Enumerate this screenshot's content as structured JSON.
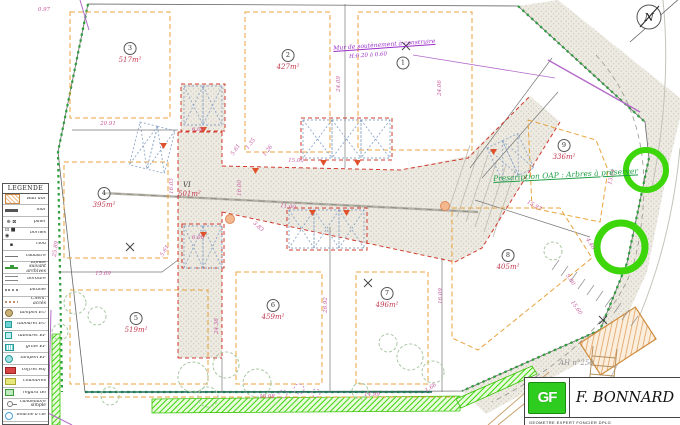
{
  "plan": {
    "north_label": "N",
    "road_label": {
      "name": "VI",
      "area": "501m²"
    },
    "lots": [
      {
        "num": "1",
        "area": "",
        "x": 403,
        "y": 63
      },
      {
        "num": "2",
        "area": "427m²",
        "x": 288,
        "y": 60
      },
      {
        "num": "3",
        "area": "517m²",
        "x": 130,
        "y": 53
      },
      {
        "num": "4",
        "area": "395m²",
        "x": 104,
        "y": 198
      },
      {
        "num": "5",
        "area": "519m²",
        "x": 136,
        "y": 323
      },
      {
        "num": "6",
        "area": "459m²",
        "x": 273,
        "y": 310
      },
      {
        "num": "7",
        "area": "496m²",
        "x": 387,
        "y": 298
      },
      {
        "num": "8",
        "area": "405m²",
        "x": 508,
        "y": 260
      },
      {
        "num": "9",
        "area": "336m²",
        "x": 564,
        "y": 150
      }
    ],
    "dimensions": [
      {
        "t": "0.97",
        "x": 44,
        "y": 10,
        "r": 0
      },
      {
        "t": "20.91",
        "x": 108,
        "y": 124,
        "r": 0
      },
      {
        "t": "24.09",
        "x": 339,
        "y": 84,
        "r": -90
      },
      {
        "t": "24.06",
        "x": 440,
        "y": 88,
        "r": -90
      },
      {
        "t": "1.35",
        "x": 251,
        "y": 144,
        "r": -52
      },
      {
        "t": "1.26",
        "x": 268,
        "y": 151,
        "r": -52
      },
      {
        "t": "15.00",
        "x": 296,
        "y": 161,
        "r": 2
      },
      {
        "t": "11.00",
        "x": 288,
        "y": 207,
        "r": 6
      },
      {
        "t": "6.00",
        "x": 198,
        "y": 130,
        "r": 0
      },
      {
        "t": "6.00",
        "x": 198,
        "y": 238,
        "r": 0
      },
      {
        "t": "16.00",
        "x": 240,
        "y": 188,
        "r": -90
      },
      {
        "t": "16.03",
        "x": 172,
        "y": 186,
        "r": -90
      },
      {
        "t": "5.61",
        "x": 236,
        "y": 150,
        "r": -55
      },
      {
        "t": "5.61",
        "x": 165,
        "y": 251,
        "r": -58
      },
      {
        "t": "3.83",
        "x": 258,
        "y": 227,
        "r": 42
      },
      {
        "t": "28.92",
        "x": 326,
        "y": 305,
        "r": -90
      },
      {
        "t": "24.38",
        "x": 217,
        "y": 326,
        "r": -90
      },
      {
        "t": "15.69",
        "x": 103,
        "y": 274,
        "r": 0
      },
      {
        "t": "25.89",
        "x": 56,
        "y": 249,
        "r": -82
      },
      {
        "t": "15.97",
        "x": 534,
        "y": 206,
        "r": 30
      },
      {
        "t": "13.84",
        "x": 612,
        "y": 177,
        "r": -76
      },
      {
        "t": "16.09",
        "x": 441,
        "y": 296,
        "r": -90
      },
      {
        "t": "4.40",
        "x": 590,
        "y": 244,
        "r": 58
      },
      {
        "t": "5.00",
        "x": 570,
        "y": 280,
        "r": 55
      },
      {
        "t": "15.60",
        "x": 576,
        "y": 308,
        "r": 55
      },
      {
        "t": "18.08",
        "x": 267,
        "y": 397,
        "r": 0
      },
      {
        "t": "14.99",
        "x": 372,
        "y": 395,
        "r": 0
      },
      {
        "t": "1.66",
        "x": 431,
        "y": 388,
        "r": -35
      }
    ],
    "annotations": [
      {
        "text": "Mur de soutènement à construire",
        "x": 333,
        "y": 45,
        "color": "#9b30c9",
        "size": 6,
        "rot": -4,
        "underline": true
      },
      {
        "text": "H:0.20 à 0.60",
        "x": 349,
        "y": 54,
        "color": "#9b30c9",
        "size": 5.5,
        "rot": -4,
        "underline": false
      },
      {
        "text": "Prescription OAP : Arbres à préserver",
        "x": 493,
        "y": 174,
        "color": "#1e9e45",
        "size": 7.5,
        "rot": -3,
        "underline": true
      },
      {
        "text": "AH n°250",
        "x": 559,
        "y": 359,
        "color": "#8f8f8f",
        "size": 7,
        "rot": 0,
        "underline": false
      }
    ],
    "legend": {
      "title": "LEGENDE",
      "items": [
        {
          "label": "Bâti dur",
          "swatch": "bati"
        },
        {
          "label": "mur",
          "swatch": "mur"
        },
        {
          "label": "pilier",
          "swatch": "glyphs",
          "glyph": "⊕ ⊠"
        },
        {
          "label": "bornes",
          "swatch": "glyphs",
          "glyph": "⊡ ■ ◉"
        },
        {
          "label": "clou",
          "swatch": "glyphs",
          "glyph": "▪"
        },
        {
          "label": "cadastre",
          "swatch": "line"
        },
        {
          "label": "Limite suivant archives",
          "swatch": "archives"
        },
        {
          "label": "bordure",
          "swatch": "bordure"
        },
        {
          "label": "bitume",
          "swatch": "bitume"
        },
        {
          "label": "Chem. accès",
          "swatch": "chem"
        },
        {
          "label": "tampon EU",
          "swatch": "tampon-eu"
        },
        {
          "label": "tabouret EU",
          "swatch": "tab-eu"
        },
        {
          "label": "tabouret EP",
          "swatch": "tab-ep"
        },
        {
          "label": "grille EP",
          "swatch": "grille"
        },
        {
          "label": "tampon EP",
          "swatch": "tampon-ep"
        },
        {
          "label": "coffret edf",
          "swatch": "coffret"
        },
        {
          "label": "chambres",
          "swatch": "chambres"
        },
        {
          "label": "regard tél",
          "swatch": "regard"
        },
        {
          "label": "candélabre simple",
          "swatch": "lamp"
        },
        {
          "label": "bouche à clé",
          "swatch": "bouche"
        }
      ]
    },
    "titleblock": {
      "logo_text": "GF",
      "name": "F. BONNARD",
      "subtitle": "GEOMETRE EXPERT FONCIER DPLG"
    },
    "colors": {
      "area_text": "#c23a50",
      "dimension_text": "#c75a9e",
      "setback_dashed": "#e8a33d",
      "road_boundary_dashed": "#d23b2f",
      "hedge_green": "#2e9e3e",
      "oap_tree_green": "#3dd60a"
    }
  }
}
